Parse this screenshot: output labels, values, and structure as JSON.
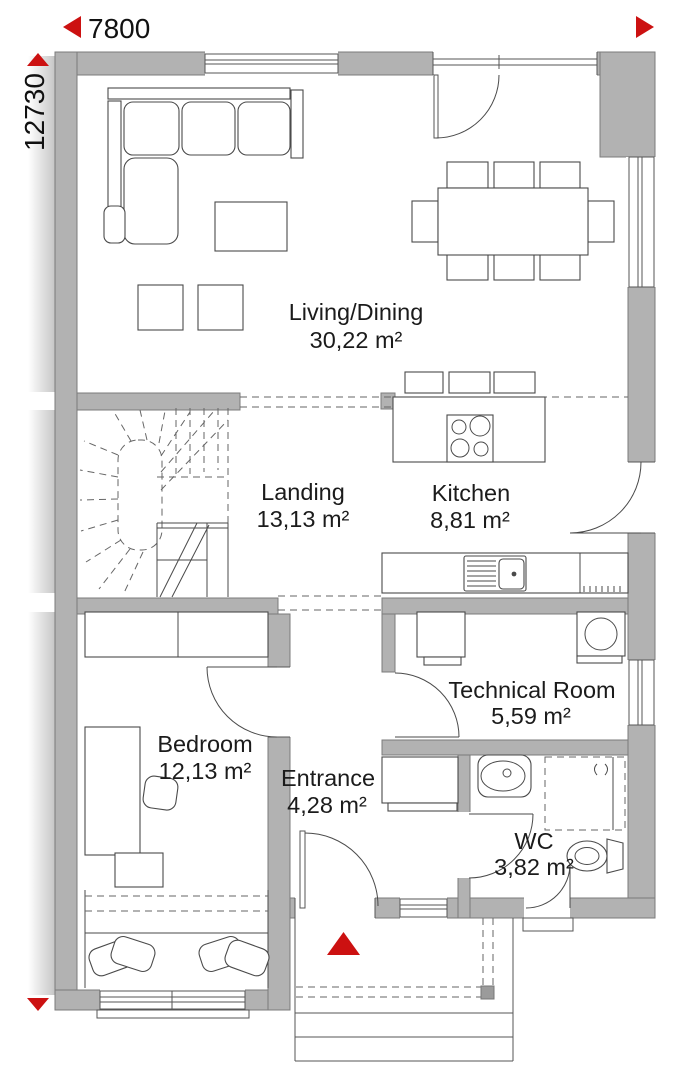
{
  "plan": {
    "dimensions": {
      "width": "7800",
      "height": "12730"
    },
    "rooms": [
      {
        "name": "Living/Dining",
        "area": "30,22 m²"
      },
      {
        "name": "Landing",
        "area": "13,13 m²"
      },
      {
        "name": "Kitchen",
        "area": "8,81 m²"
      },
      {
        "name": "Technical Room",
        "area": "5,59 m²"
      },
      {
        "name": "Bedroom",
        "area": "12,13 m²"
      },
      {
        "name": "Entrance",
        "area": "4,28 m²"
      },
      {
        "name": "WC",
        "area": "3,82 m²"
      }
    ],
    "colors": {
      "accent_red": "#cc1111",
      "wall_gray": "#b2b2b2"
    }
  }
}
